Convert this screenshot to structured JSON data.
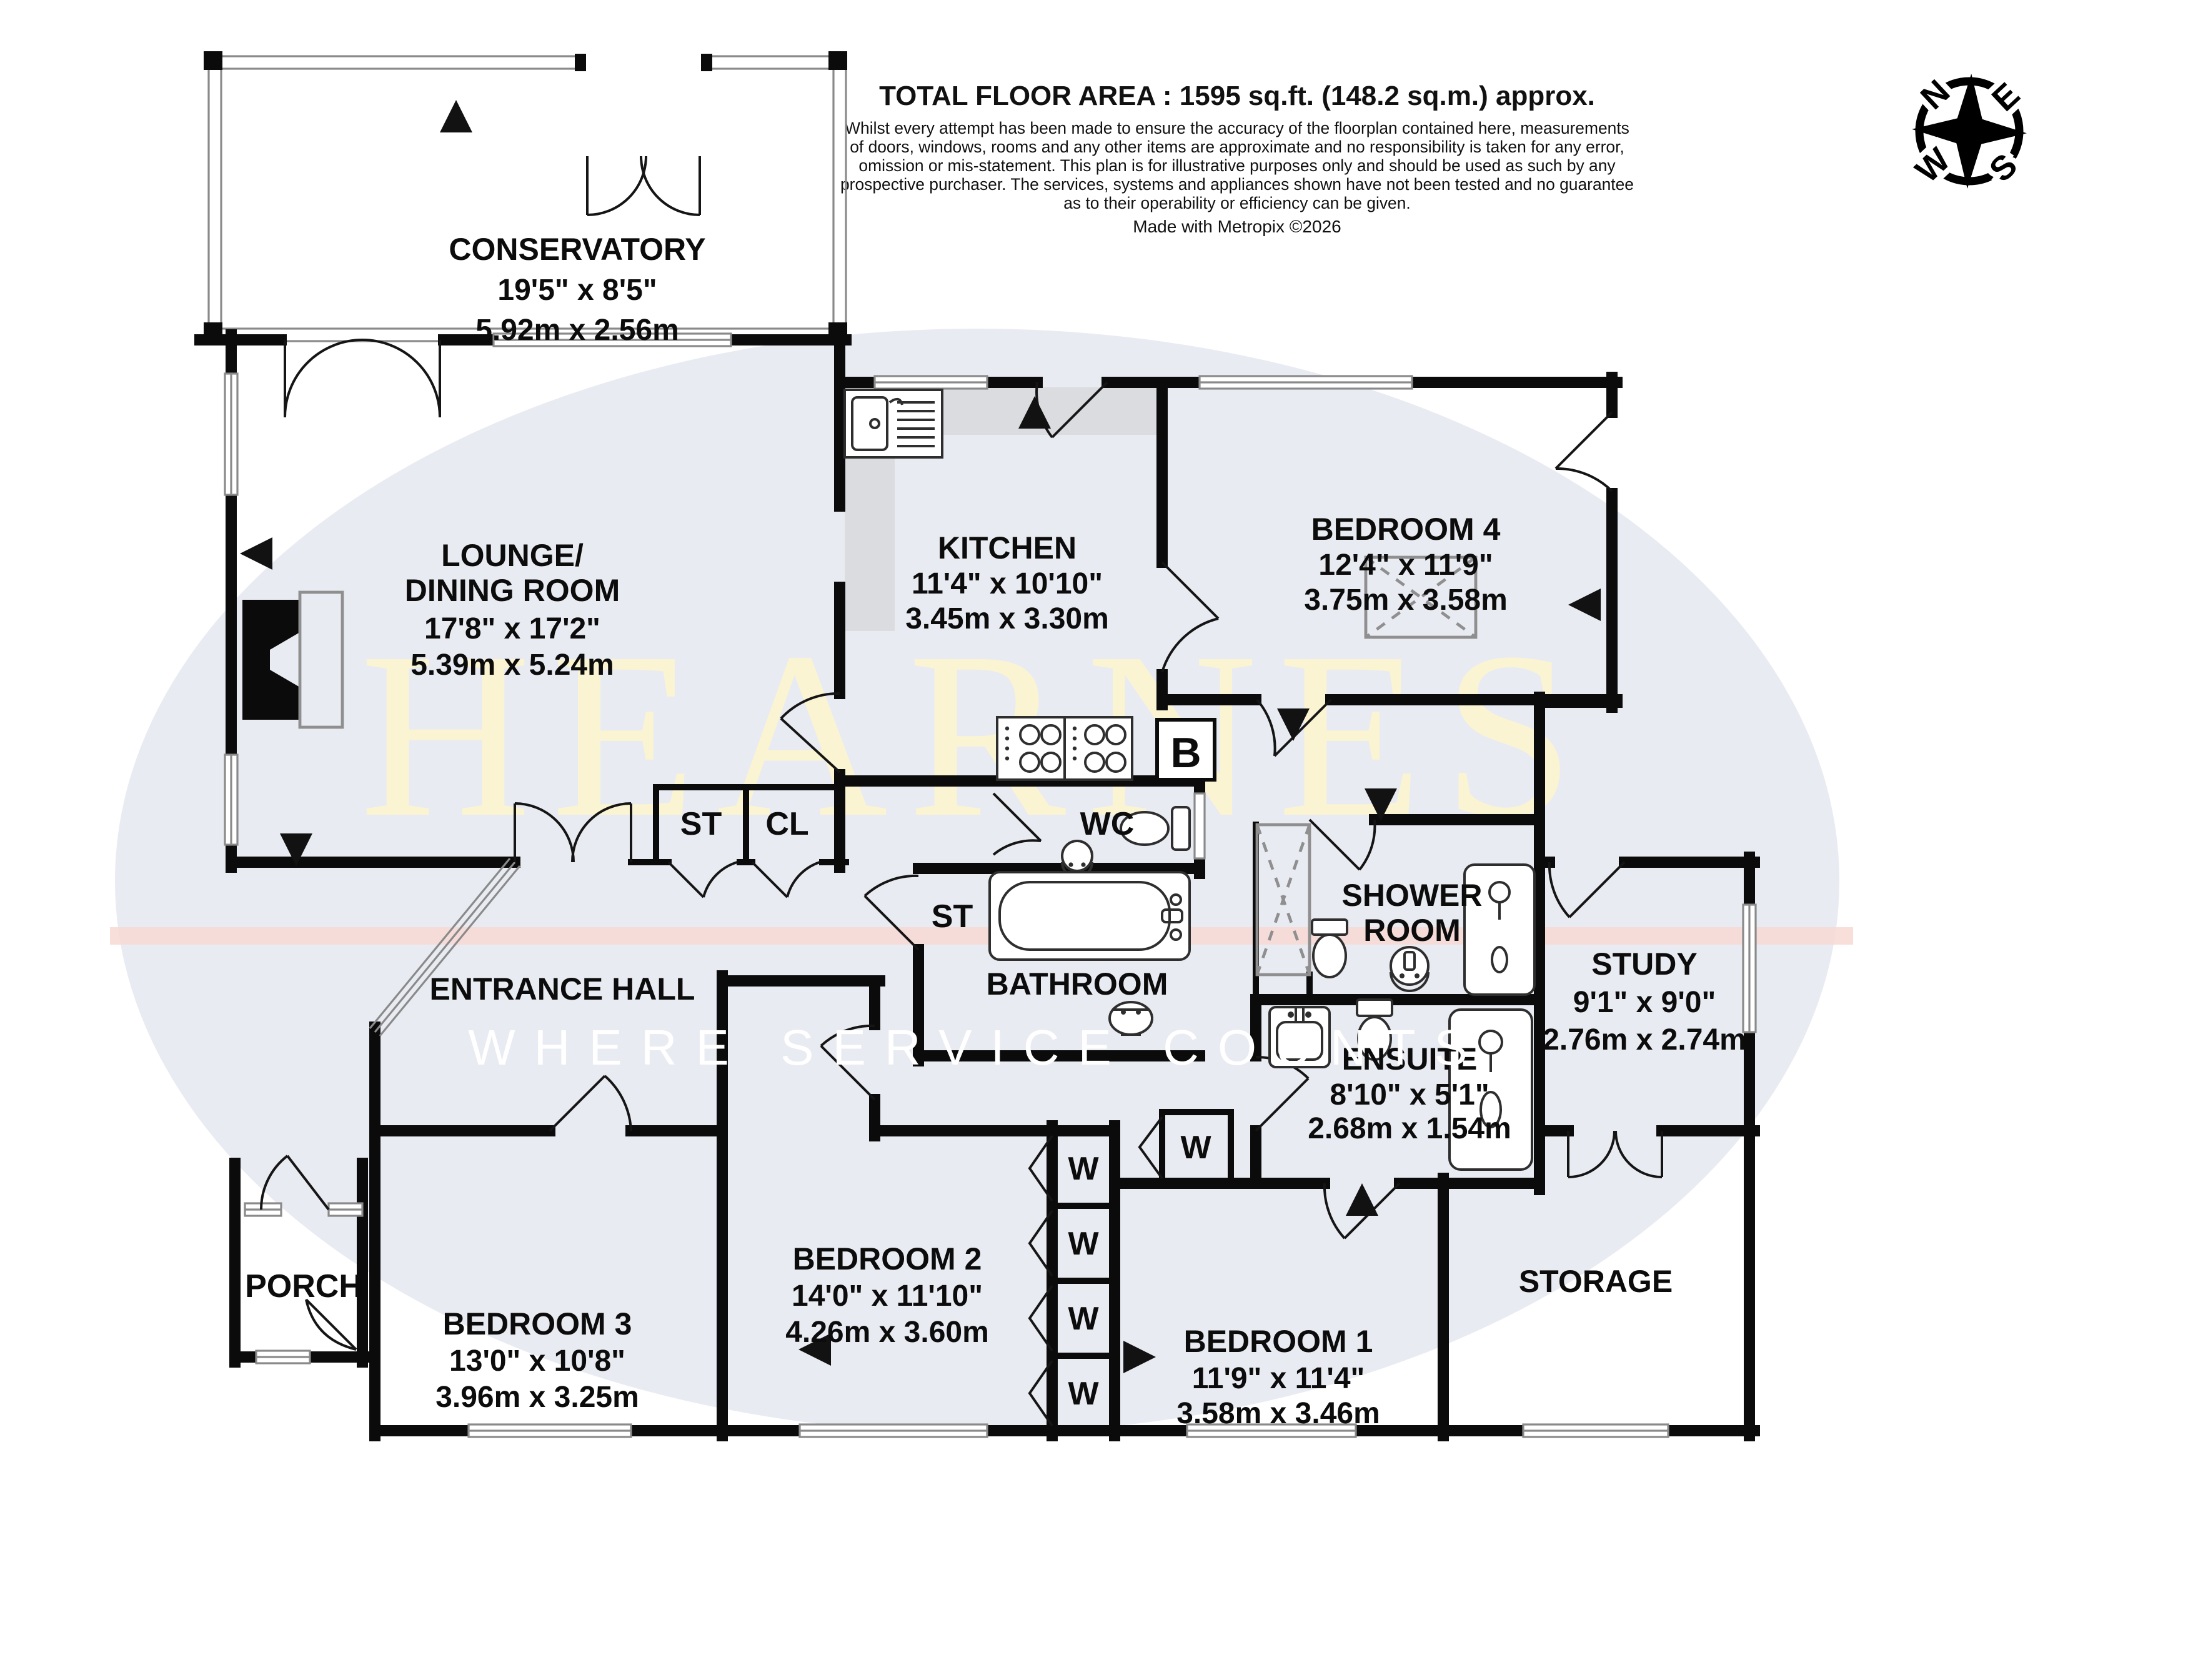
{
  "header": {
    "title": "TOTAL FLOOR AREA : 1595 sq.ft. (148.2 sq.m.) approx.",
    "disclaimer_lines": [
      "Whilst every attempt has been made to ensure the accuracy of the floorplan contained here, measurements",
      "of doors, windows, rooms and any other items are approximate and no responsibility is taken for any error,",
      "omission or mis-statement. This plan is for illustrative purposes only and should be used as such by any",
      "prospective purchaser. The services, systems and appliances shown have not been tested and no guarantee",
      "as to their operability or efficiency can be given."
    ],
    "credit": "Made with Metropix ©2026"
  },
  "compass": {
    "n": "N",
    "e": "E",
    "s": "S",
    "w": "W"
  },
  "watermark": {
    "brand": "HEARNES",
    "tagline": "WHERE SERVICE COUNTS",
    "brand_color": "#FBF4D2",
    "tagline_color": "#FFFFFF",
    "ellipse_color": "#E9EBF2",
    "stripe_color": "#F8D9D3"
  },
  "rooms": {
    "conservatory": {
      "name": "CONSERVATORY",
      "dims_ft": "19'5\"  x 8'5\"",
      "dims_m": "5.92m  x 2.56m"
    },
    "lounge": {
      "name_line1": "LOUNGE/",
      "name_line2": "DINING ROOM",
      "dims_ft": "17'8\"  x 17'2\"",
      "dims_m": "5.39m  x 5.24m"
    },
    "kitchen": {
      "name": "KITCHEN",
      "dims_ft": "11'4\"  x 10'10\"",
      "dims_m": "3.45m  x 3.30m"
    },
    "bedroom4": {
      "name": "BEDROOM 4",
      "dims_ft": "12'4\"  x 11'9\"",
      "dims_m": "3.75m  x 3.58m"
    },
    "wc": {
      "name": "WC"
    },
    "shower_room": {
      "name_line1": "SHOWER",
      "name_line2": "ROOM"
    },
    "hall_st": {
      "name": "ST"
    },
    "hall_cl": {
      "name": "CL"
    },
    "entrance_hall": {
      "name": "ENTRANCE HALL"
    },
    "bathroom_st": {
      "name": "ST"
    },
    "bathroom": {
      "name": "BATHROOM"
    },
    "ensuite": {
      "name": "ENSUITE",
      "dims_ft": "8'10\"  x 5'1\"",
      "dims_m": "2.68m  x 1.54m"
    },
    "study": {
      "name": "STUDY",
      "dims_ft": "9'1\"  x 9'0\"",
      "dims_m": "2.76m  x 2.74m"
    },
    "porch": {
      "name": "PORCH"
    },
    "bedroom3": {
      "name": "BEDROOM 3",
      "dims_ft": "13'0\"  x 10'8\"",
      "dims_m": "3.96m  x 3.25m"
    },
    "bedroom2": {
      "name": "BEDROOM 2",
      "dims_ft": "14'0\"  x 11'10\"",
      "dims_m": "4.26m  x 3.60m"
    },
    "bedroom1": {
      "name": "BEDROOM 1",
      "dims_ft": "11'9\"  x 11'4\"",
      "dims_m": "3.58m  x 3.46m"
    },
    "storage": {
      "name": "STORAGE"
    }
  },
  "labels": {
    "wardrobe": "W",
    "boiler": "B"
  }
}
